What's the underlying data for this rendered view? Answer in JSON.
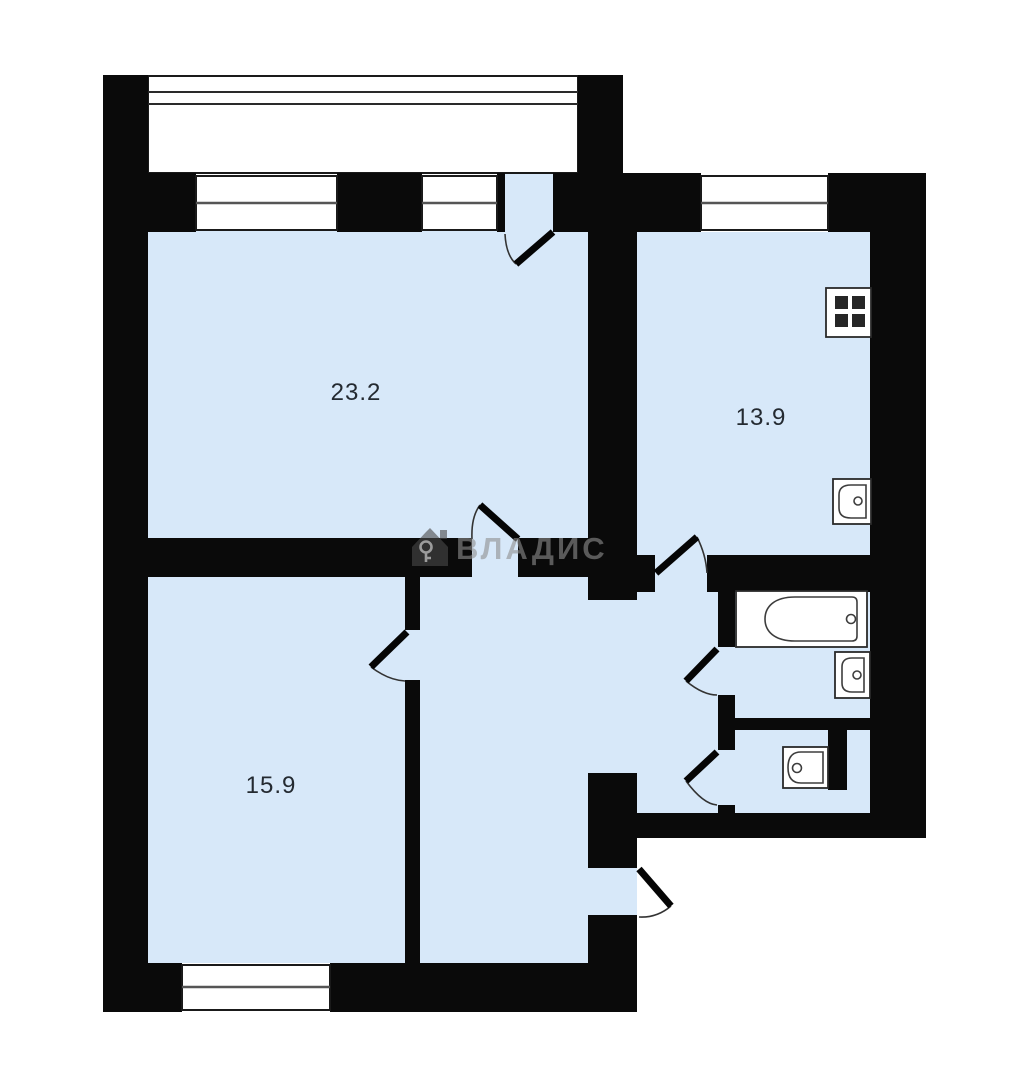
{
  "plan": {
    "type": "apartment-floor-plan",
    "watermark": {
      "text": "ВЛАДИС",
      "icon": "house-key-icon"
    },
    "rooms": [
      {
        "id": "living-room",
        "area_label": "23.2"
      },
      {
        "id": "kitchen",
        "area_label": "13.9"
      },
      {
        "id": "bedroom",
        "area_label": "15.9"
      }
    ],
    "fixtures": [
      "stove-icon",
      "kitchen-sink-icon",
      "bathtub-icon",
      "bathroom-sink-icon",
      "toilet-icon"
    ],
    "features": [
      "balcony-with-railing",
      "double-pane-windows",
      "swing-doors",
      "entrance-door",
      "duct-shaft"
    ],
    "colors": {
      "room-fill": "#d7e8f9",
      "wall": "#0a0a0a",
      "outside": "#ffffff",
      "fixture-outline": "#3d3d3d",
      "label": "#242a31",
      "watermark": "#8f8f8f"
    }
  }
}
